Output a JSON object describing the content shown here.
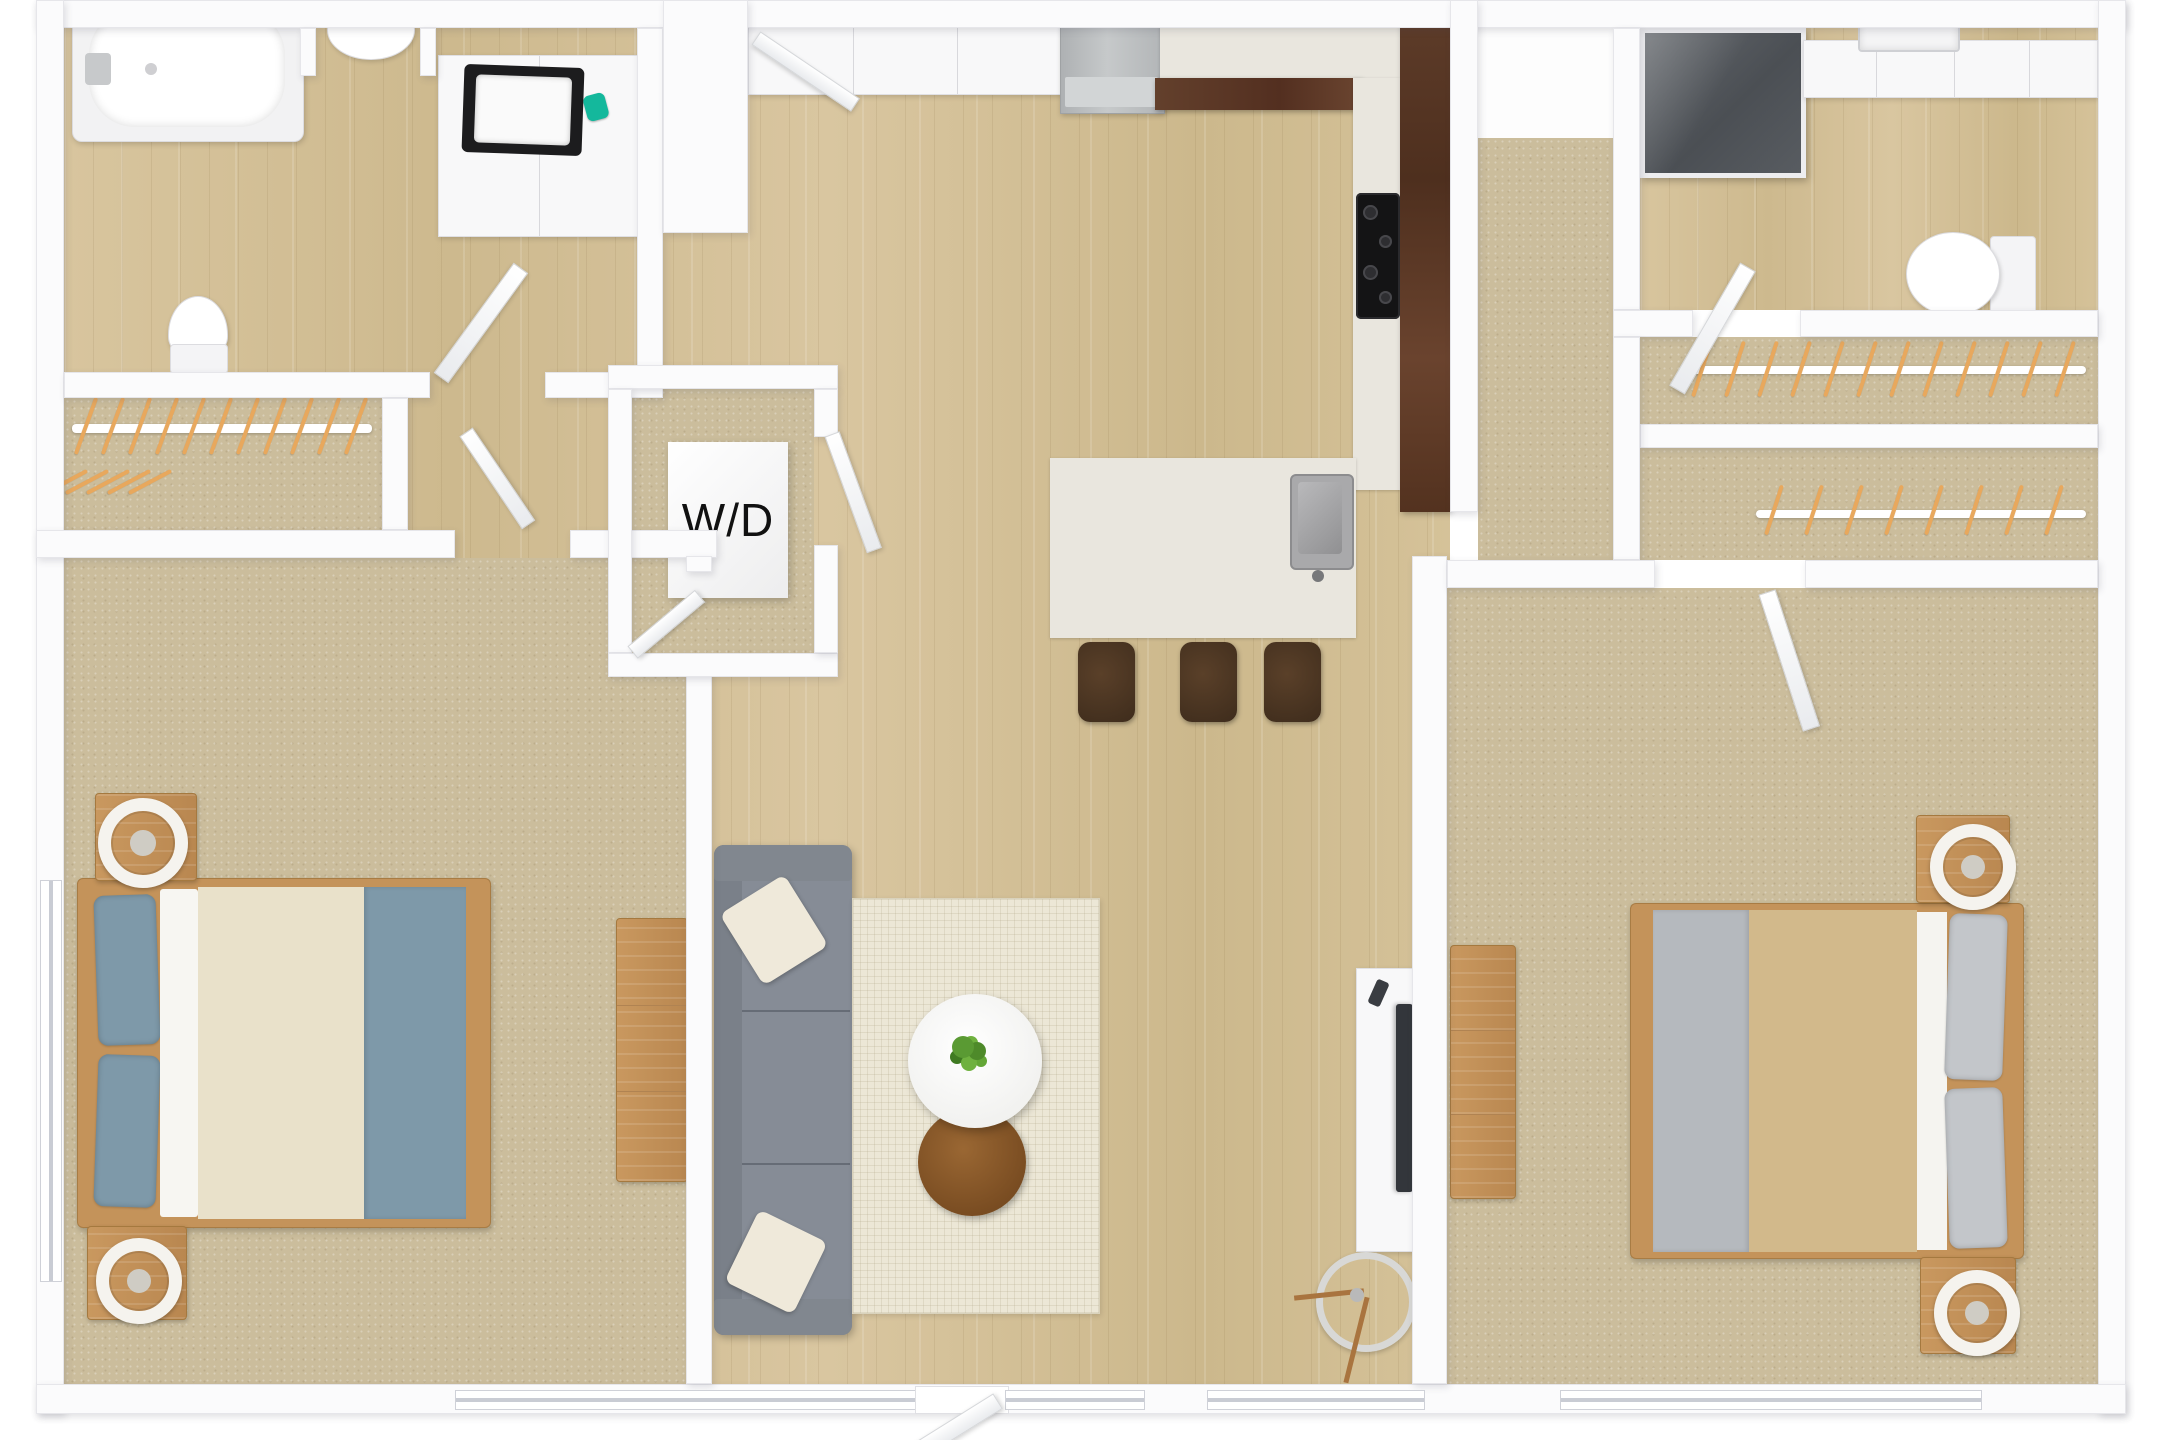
{
  "floorplan": {
    "wd_label": "W/D",
    "palette": {
      "wall": "#fbfbfc",
      "wood": "#d4c198",
      "carpet": "#cbbd9c",
      "granite": "#e9e6de",
      "bar_wood": "#5d3b2a",
      "hanger": "#e8a85d",
      "bedblue": "#7e99a9",
      "bed_tan": "#d2b98b",
      "couch_gray": "#868c96",
      "ottoman_brown": "#8a5a2b",
      "accent_teal": "#14b89c"
    }
  },
  "hanger_groups": [
    {
      "x": 84,
      "y": 396,
      "count": 11,
      "step": 27,
      "h": 60,
      "rot": 20
    },
    {
      "x": 64,
      "y": 458,
      "count": 5,
      "step": 21,
      "h": 48,
      "rot": 62
    },
    {
      "x": 1700,
      "y": 340,
      "count": 12,
      "step": 33,
      "h": 58,
      "rot": 18
    },
    {
      "x": 1772,
      "y": 484,
      "count": 8,
      "step": 40,
      "h": 52,
      "rot": 18
    }
  ]
}
